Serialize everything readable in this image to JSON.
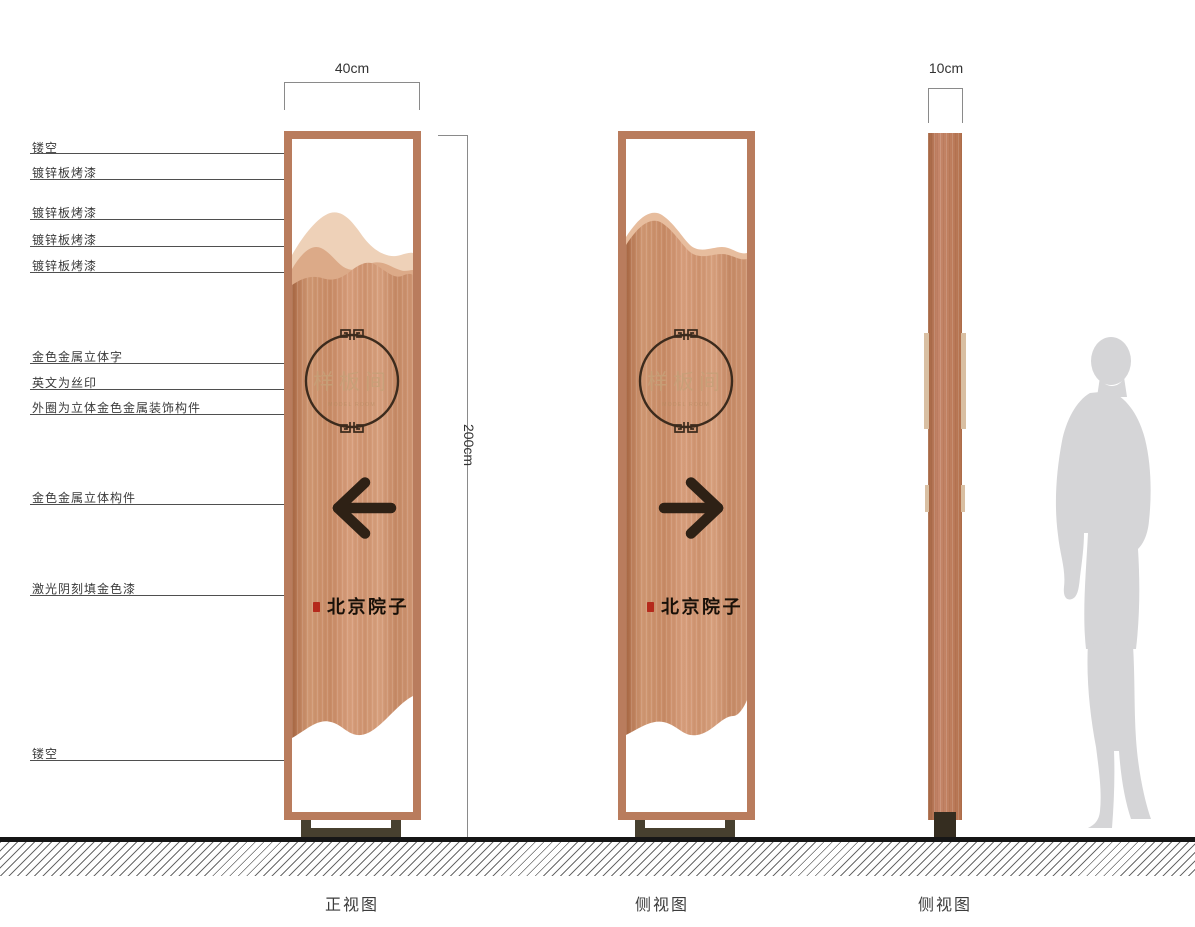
{
  "canvas": {
    "background": "#ffffff"
  },
  "callouts": [
    {
      "text": "镂空"
    },
    {
      "text": "镀锌板烤漆"
    },
    {
      "text": "镀锌板烤漆"
    },
    {
      "text": "镀锌板烤漆"
    },
    {
      "text": "镀锌板烤漆"
    },
    {
      "text": "金色金属立体字"
    },
    {
      "text": "英文为丝印"
    },
    {
      "text": "外圈为立体金色金属装饰构件"
    },
    {
      "text": "金色金属立体构件"
    },
    {
      "text": "激光阴刻填金色漆"
    },
    {
      "text": "镂空"
    }
  ],
  "dimensions": {
    "width": "40cm",
    "height": "200cm",
    "depth": "10cm"
  },
  "panel": {
    "name_text": "样板间",
    "name_subtext": "MODEL ROOM",
    "brand_text": "北京院子"
  },
  "views": [
    {
      "caption": "正视图"
    },
    {
      "caption": "侧视图"
    },
    {
      "caption": "侧视图"
    }
  ],
  "colors": {
    "copper_main": "#cf9470",
    "frame": "#b97c5d",
    "line_dark": "#2e2115",
    "seal_red": "#b52a1c",
    "mountain_light": "#eed1b8",
    "mountain_mid": "#dcaa88",
    "silhouette_gray": "#d5d5d7"
  }
}
